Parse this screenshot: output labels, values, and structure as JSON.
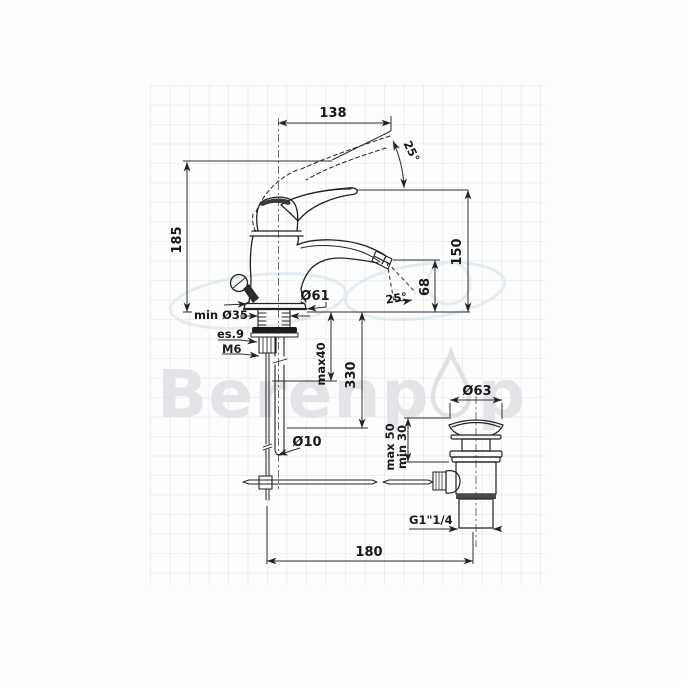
{
  "watermark": {
    "text_left": "Berenp",
    "text_right": "p",
    "color": "#e2e4e7",
    "droplet_color": "#dfe2e5",
    "swoosh_color": "#cfe0ec"
  },
  "drawing": {
    "line_color": "#222222",
    "dim_color": "#2e2e2e",
    "title": "basin mixer with pop-up waste technical drawing"
  },
  "labels": {
    "width_138": "138",
    "angle_25_top": "25°",
    "height_185": "185",
    "height_150": "150",
    "height_68": "68",
    "dia_61": "Ø61",
    "angle_25_spout": "25°",
    "min_dia_35": "min Ø35",
    "hex_es9": "es.9",
    "thread_m6": "M6",
    "max_40": "max40",
    "len_330": "330",
    "dia_10": "Ø10",
    "dia_63": "Ø63",
    "max_50": "max 50",
    "min_30": "min 30",
    "thread_g114": "G1\"1/4",
    "dist_180": "180"
  }
}
